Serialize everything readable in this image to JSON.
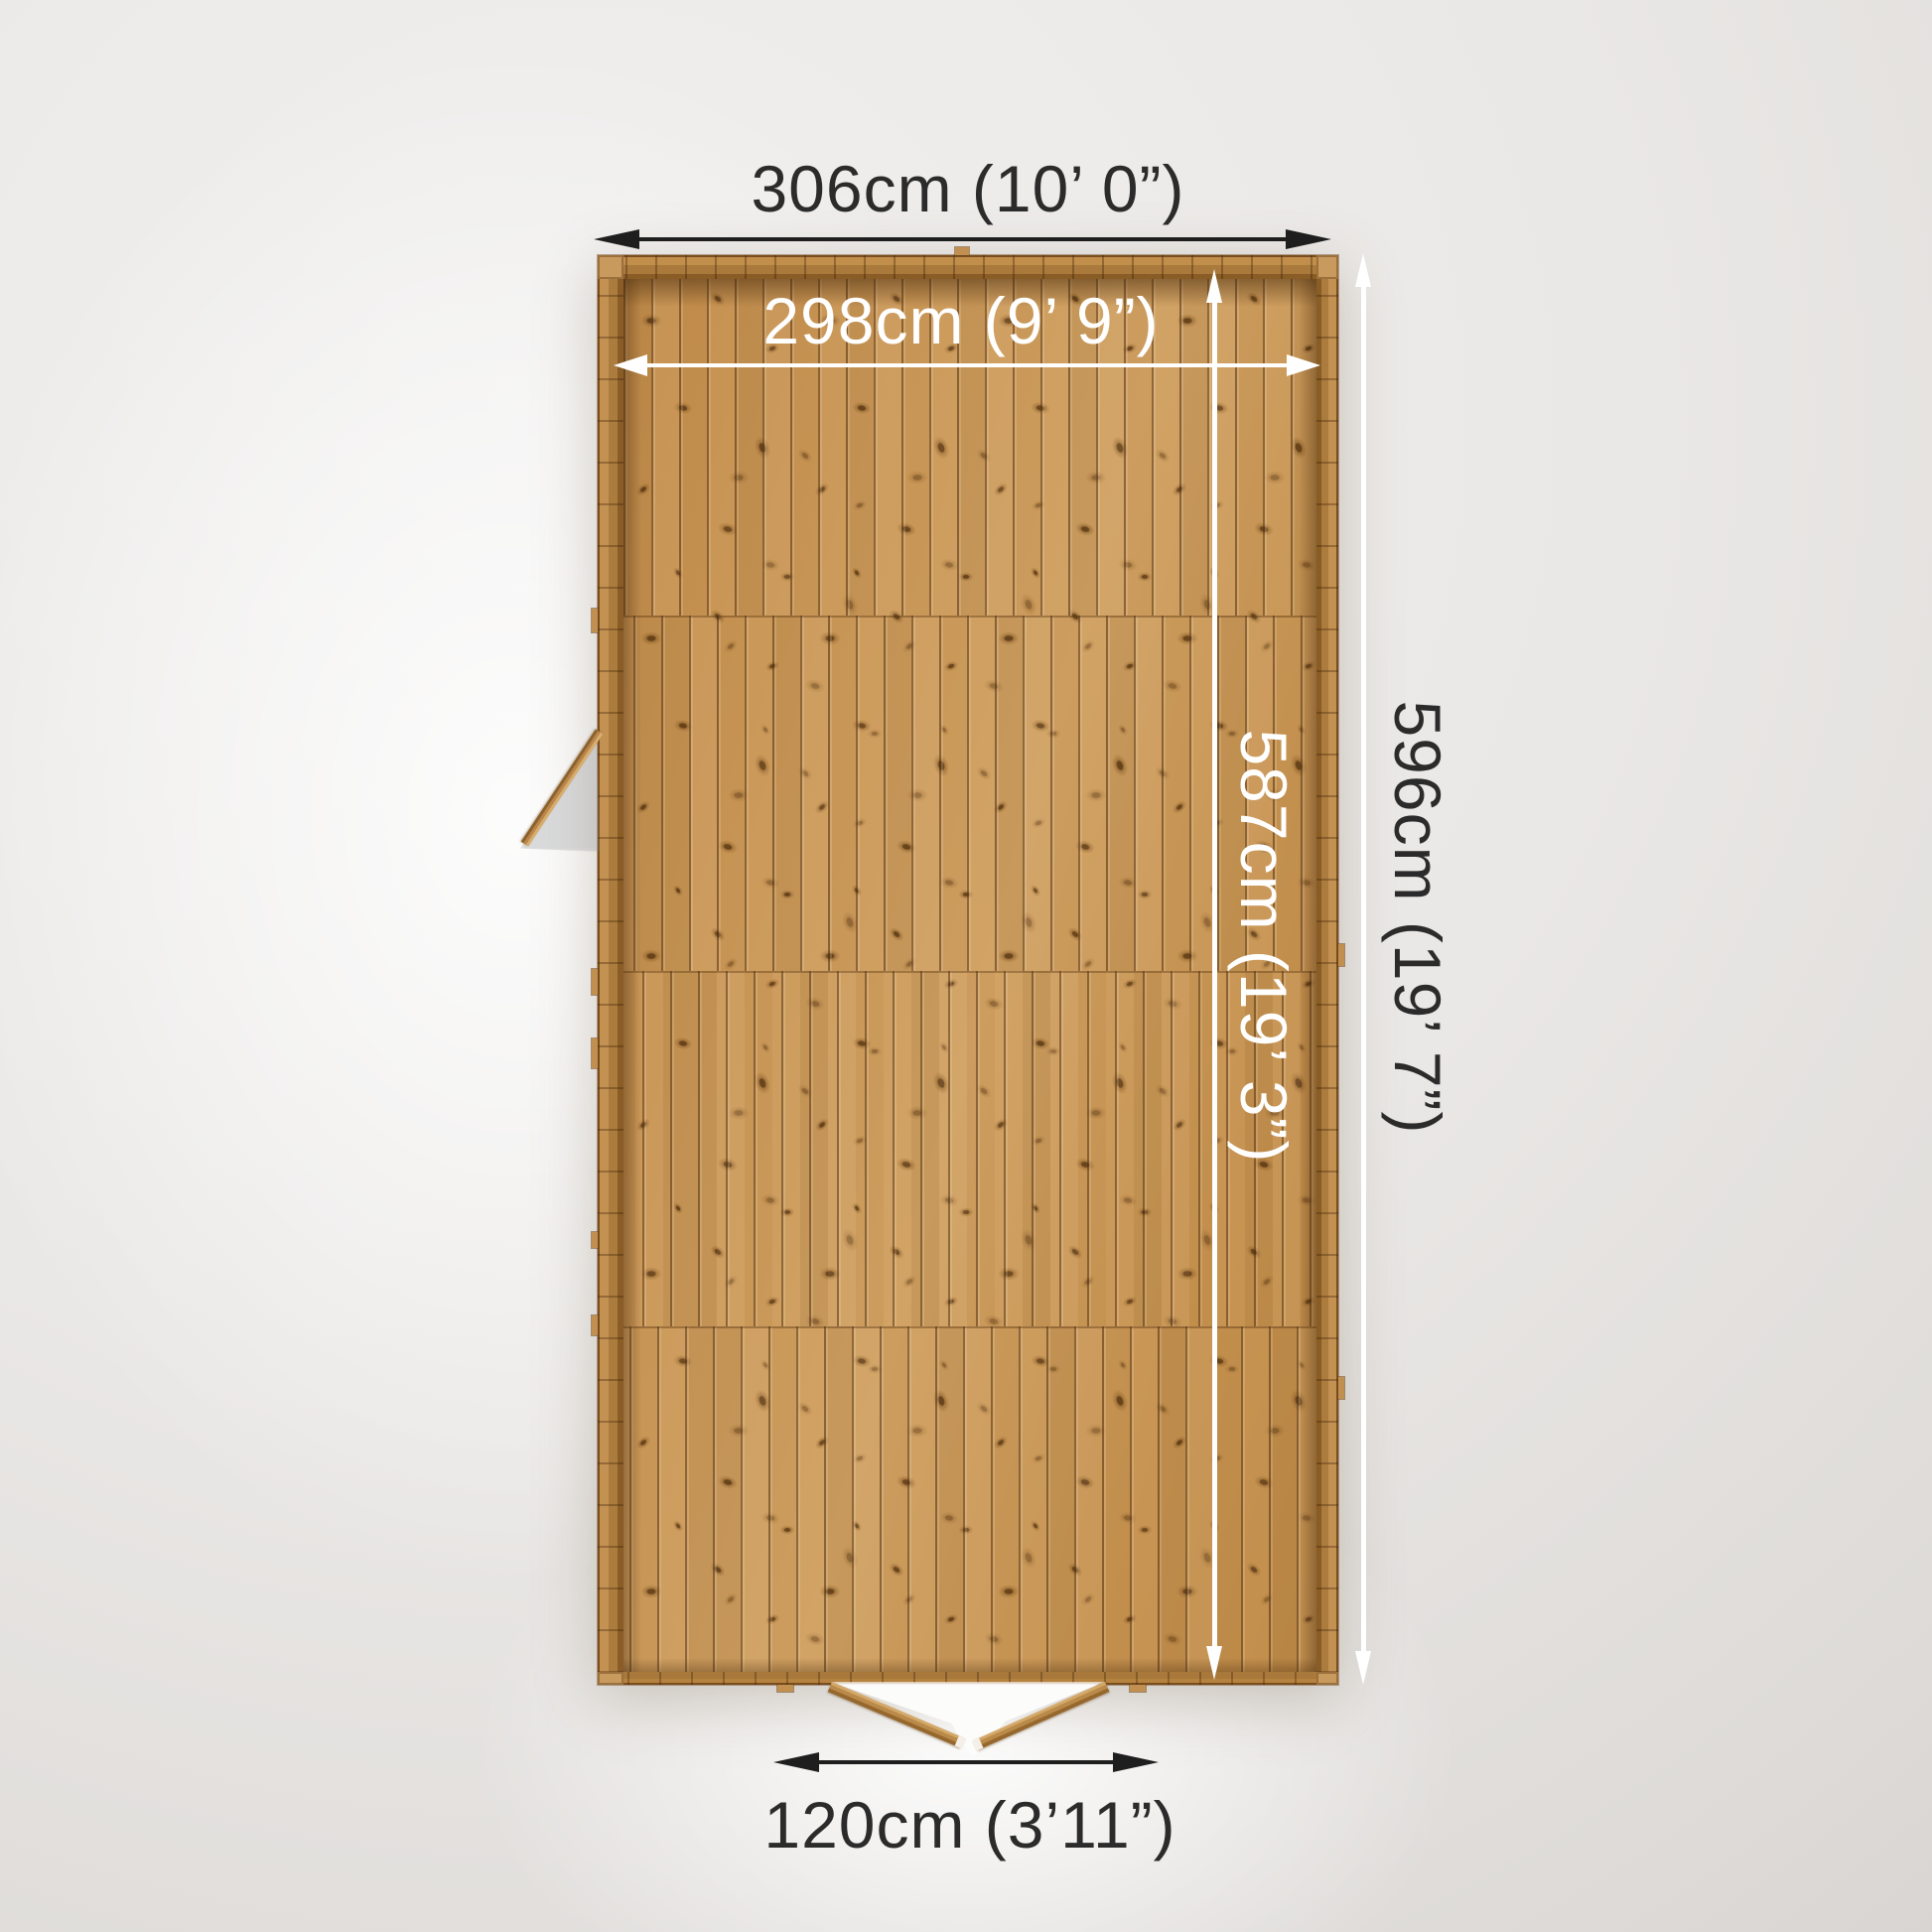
{
  "dimensions": {
    "external_width_label": "306cm (10’ 0”)",
    "internal_width_label": "298cm (9’ 9”)",
    "internal_depth_label": "587cm (19’ 3”)",
    "external_depth_label": "596cm (19’ 7”)",
    "door_width_label": "120cm (3’11”)"
  },
  "colors": {
    "dark_label": "#2b2b2b",
    "light_label": "#ffffff",
    "wood_base": "#c9965a",
    "wood_dark_line": "#7a4e1d",
    "wall_wood": "#b5803e",
    "background_gray": "#e7e5e3"
  }
}
